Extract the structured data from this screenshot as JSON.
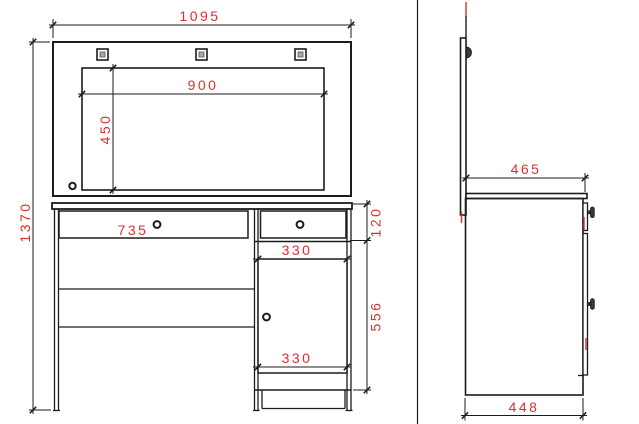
{
  "drawing": {
    "type": "furniture-technical-drawing",
    "subject": "dressing table with mirror - front and side elevations",
    "units": "mm",
    "colors": {
      "outline": "#1c1c1c",
      "dimension_text": "#d93030",
      "background": "#ffffff",
      "fixture_fill": "#a8a8a8"
    },
    "front_view": {
      "dims": {
        "overall_width": "1095",
        "overall_height": "1370",
        "mirror_width": "900",
        "mirror_height": "450",
        "left_drawer_width": "735",
        "drawer_height": "120",
        "pedestal_top_width": "330",
        "door_height": "556",
        "pedestal_bottom_width": "330"
      }
    },
    "side_view": {
      "dims": {
        "top_depth": "465",
        "base_depth": "448"
      }
    }
  }
}
